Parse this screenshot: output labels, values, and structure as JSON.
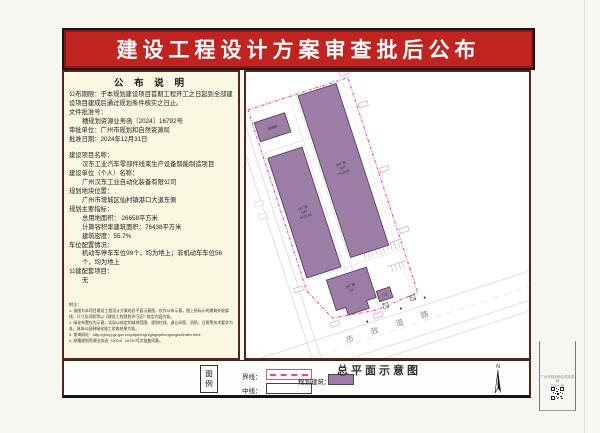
{
  "banner": {
    "title": "建设工程设计方案审查批后公布"
  },
  "notice": {
    "header": "公 布 说 明",
    "lines": [
      {
        "text": "公布期限：于本规划建设项目首期工程开工之日起到全部建设项目建成后通过规划条件核实之日止。",
        "indent": false
      },
      {
        "text": "文件批准号：",
        "indent": false
      },
      {
        "text": "穗规划资源业务函〔2024〕16792号",
        "indent": true
      },
      {
        "text": "审批单位：广州市规划和自然资源局",
        "indent": false
      },
      {
        "text": "批准日期：2024年12月31日",
        "indent": false
      },
      {
        "text": "建设项目名称：",
        "indent": false,
        "gap": true
      },
      {
        "text": "汉东工业汽车零部件线束生产设备智能制造项目",
        "indent": true
      },
      {
        "text": "建设单位（个人）名称：",
        "indent": false
      },
      {
        "text": "广州汉东工业自动化装备有限公司",
        "indent": true
      },
      {
        "text": "规划地块位置：",
        "indent": false
      },
      {
        "text": "广州市增城区仙村镇港口大道东侧",
        "indent": true
      },
      {
        "text": "规划主要指标：",
        "indent": false
      },
      {
        "text": "总用地面积： 26658平方米",
        "indent": true
      },
      {
        "text": "计算容积率建筑面积：76438平方米",
        "indent": true
      },
      {
        "text": "建筑密度：55.7%",
        "indent": true
      },
      {
        "text": "车位配置情况：",
        "indent": false
      },
      {
        "text": "机动车停车车位99个，均为地上；非机动车车位56个，均为地上",
        "indent": true
      },
      {
        "text": "公建配套项目：",
        "indent": false
      },
      {
        "text": "无",
        "indent": true
      }
    ],
    "notes_label": "附注：",
    "notes": [
      "1. 该图为本项目建设工程设计方案的总平面示意图，仅作公布示意。图上所标示的建筑外轮廓线、尺寸及间距等以《建设工程规划许可证》核定内容为准。",
      "2. 绿化布置仅为示意，实际以核定的绿地范围、规划红线、退让间距、消防、日照等技术要求为准，具体以园林绿化竣工验收结果为准。",
      "3. 查询网址：http://ghzyj.gz.gov.cn/ywpd/cxgh/ghgs/pihougongbu/index.html",
      "4. 经穗规划资源业务函〔2024〕16792号文批复同意。"
    ]
  },
  "plan": {
    "road_label": "市 政 道 路",
    "buildings": [
      {
        "name": "workshop-1",
        "label_lines": [
          "1#厂房",
          "（5F）",
          "H=23.95"
        ]
      },
      {
        "name": "workshop-2",
        "label_lines": [
          "2#厂房",
          "（5F）",
          "H=23.95"
        ]
      },
      {
        "name": "workshop-3",
        "label_lines": [
          "3#厂房",
          "2F"
        ]
      },
      {
        "name": "substation",
        "label_lines": [
          "配电房"
        ]
      },
      {
        "name": "gatehouse",
        "label_lines": [
          "门卫"
        ]
      }
    ],
    "colors": {
      "building": "#9c7da6",
      "boundary": "#f23fa0",
      "road": "#d9d8d2"
    }
  },
  "legend": {
    "box_label": "图例",
    "title": "总平面示意图",
    "items": [
      {
        "label": "界线：",
        "sample": "dashed-magenta"
      },
      {
        "label": "中线：",
        "sample": "empty-box"
      },
      {
        "label": "规划建筑：",
        "sample": "purple-fill"
      }
    ],
    "north_label": "N"
  },
  "side_strip": {
    "line1": "广州市规划和自然资源局",
    "line2": "批后公布",
    "qr": "qr-code"
  }
}
